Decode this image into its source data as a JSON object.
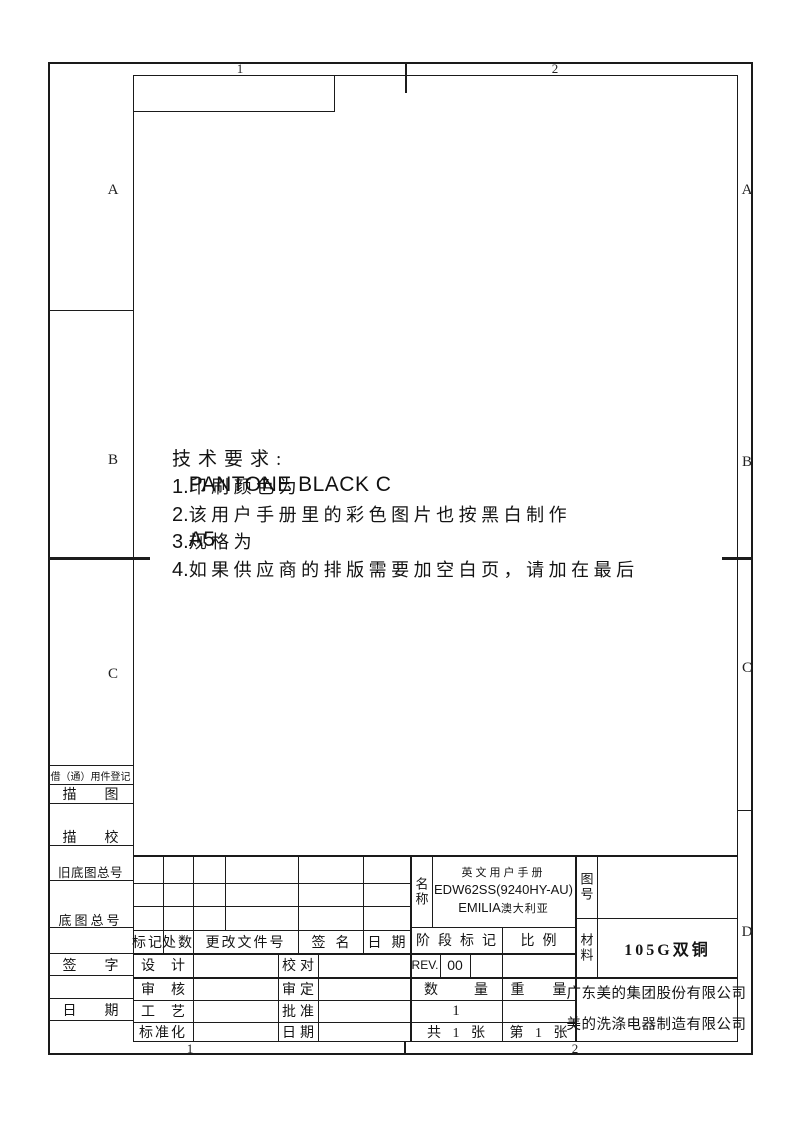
{
  "sheet": {
    "zone_labels": {
      "top": [
        "1",
        "2"
      ],
      "bottom": [
        "1",
        "2"
      ],
      "left": [
        "A",
        "B",
        "C"
      ],
      "right": [
        "A",
        "B",
        "C",
        "D"
      ]
    }
  },
  "tech_requirements": {
    "title": "技术要求:",
    "items": [
      {
        "num": "1.",
        "cn": "印刷颜色为",
        "latin": "PANTONE BLACK C"
      },
      {
        "num": "2.",
        "cn": "该用户手册里的彩色图片也按黑白制作",
        "latin": ""
      },
      {
        "num": "3.",
        "cn": "规格为",
        "latin": "A5"
      },
      {
        "num": "4.",
        "cn": "如果供应商的排版需要加空白页，请加在最后",
        "latin": ""
      }
    ]
  },
  "left_strip": {
    "labels": [
      "借（通）用件登记",
      "描图",
      "描校",
      "旧底图总号",
      "底图总号",
      "签字",
      "日期"
    ]
  },
  "title_block": {
    "revision_header": {
      "mark": "标记",
      "count": "处数",
      "file_no": "更改文件号",
      "sign": "签名",
      "date": "日期"
    },
    "approval_rows": [
      {
        "l": "设计",
        "r": "校对"
      },
      {
        "l": "审核",
        "r": "审定"
      },
      {
        "l": "工艺",
        "r": "批准"
      },
      {
        "l": "标准化",
        "r": "日期"
      }
    ],
    "name_block": {
      "label": "名称",
      "line1": "英文用户手册",
      "line2": "EDW62SS(9240HY-AU)",
      "line3_model": "EMILIA",
      "line3_region": "澳大利亚"
    },
    "drawing_no": {
      "label": "图号"
    },
    "material": {
      "label": "材料",
      "value": "105G双铜"
    },
    "stage": {
      "header": "阶段标记",
      "scale_header": "比例",
      "rev": "REV.",
      "rev_value": "00"
    },
    "quantity": {
      "header": "数量",
      "weight_header": "重量",
      "value": "1",
      "total": "共 1 张",
      "sheet": "第 1 张"
    },
    "company": [
      "广东美的集团股份有限公司",
      "美的洗涤电器制造有限公司"
    ]
  }
}
